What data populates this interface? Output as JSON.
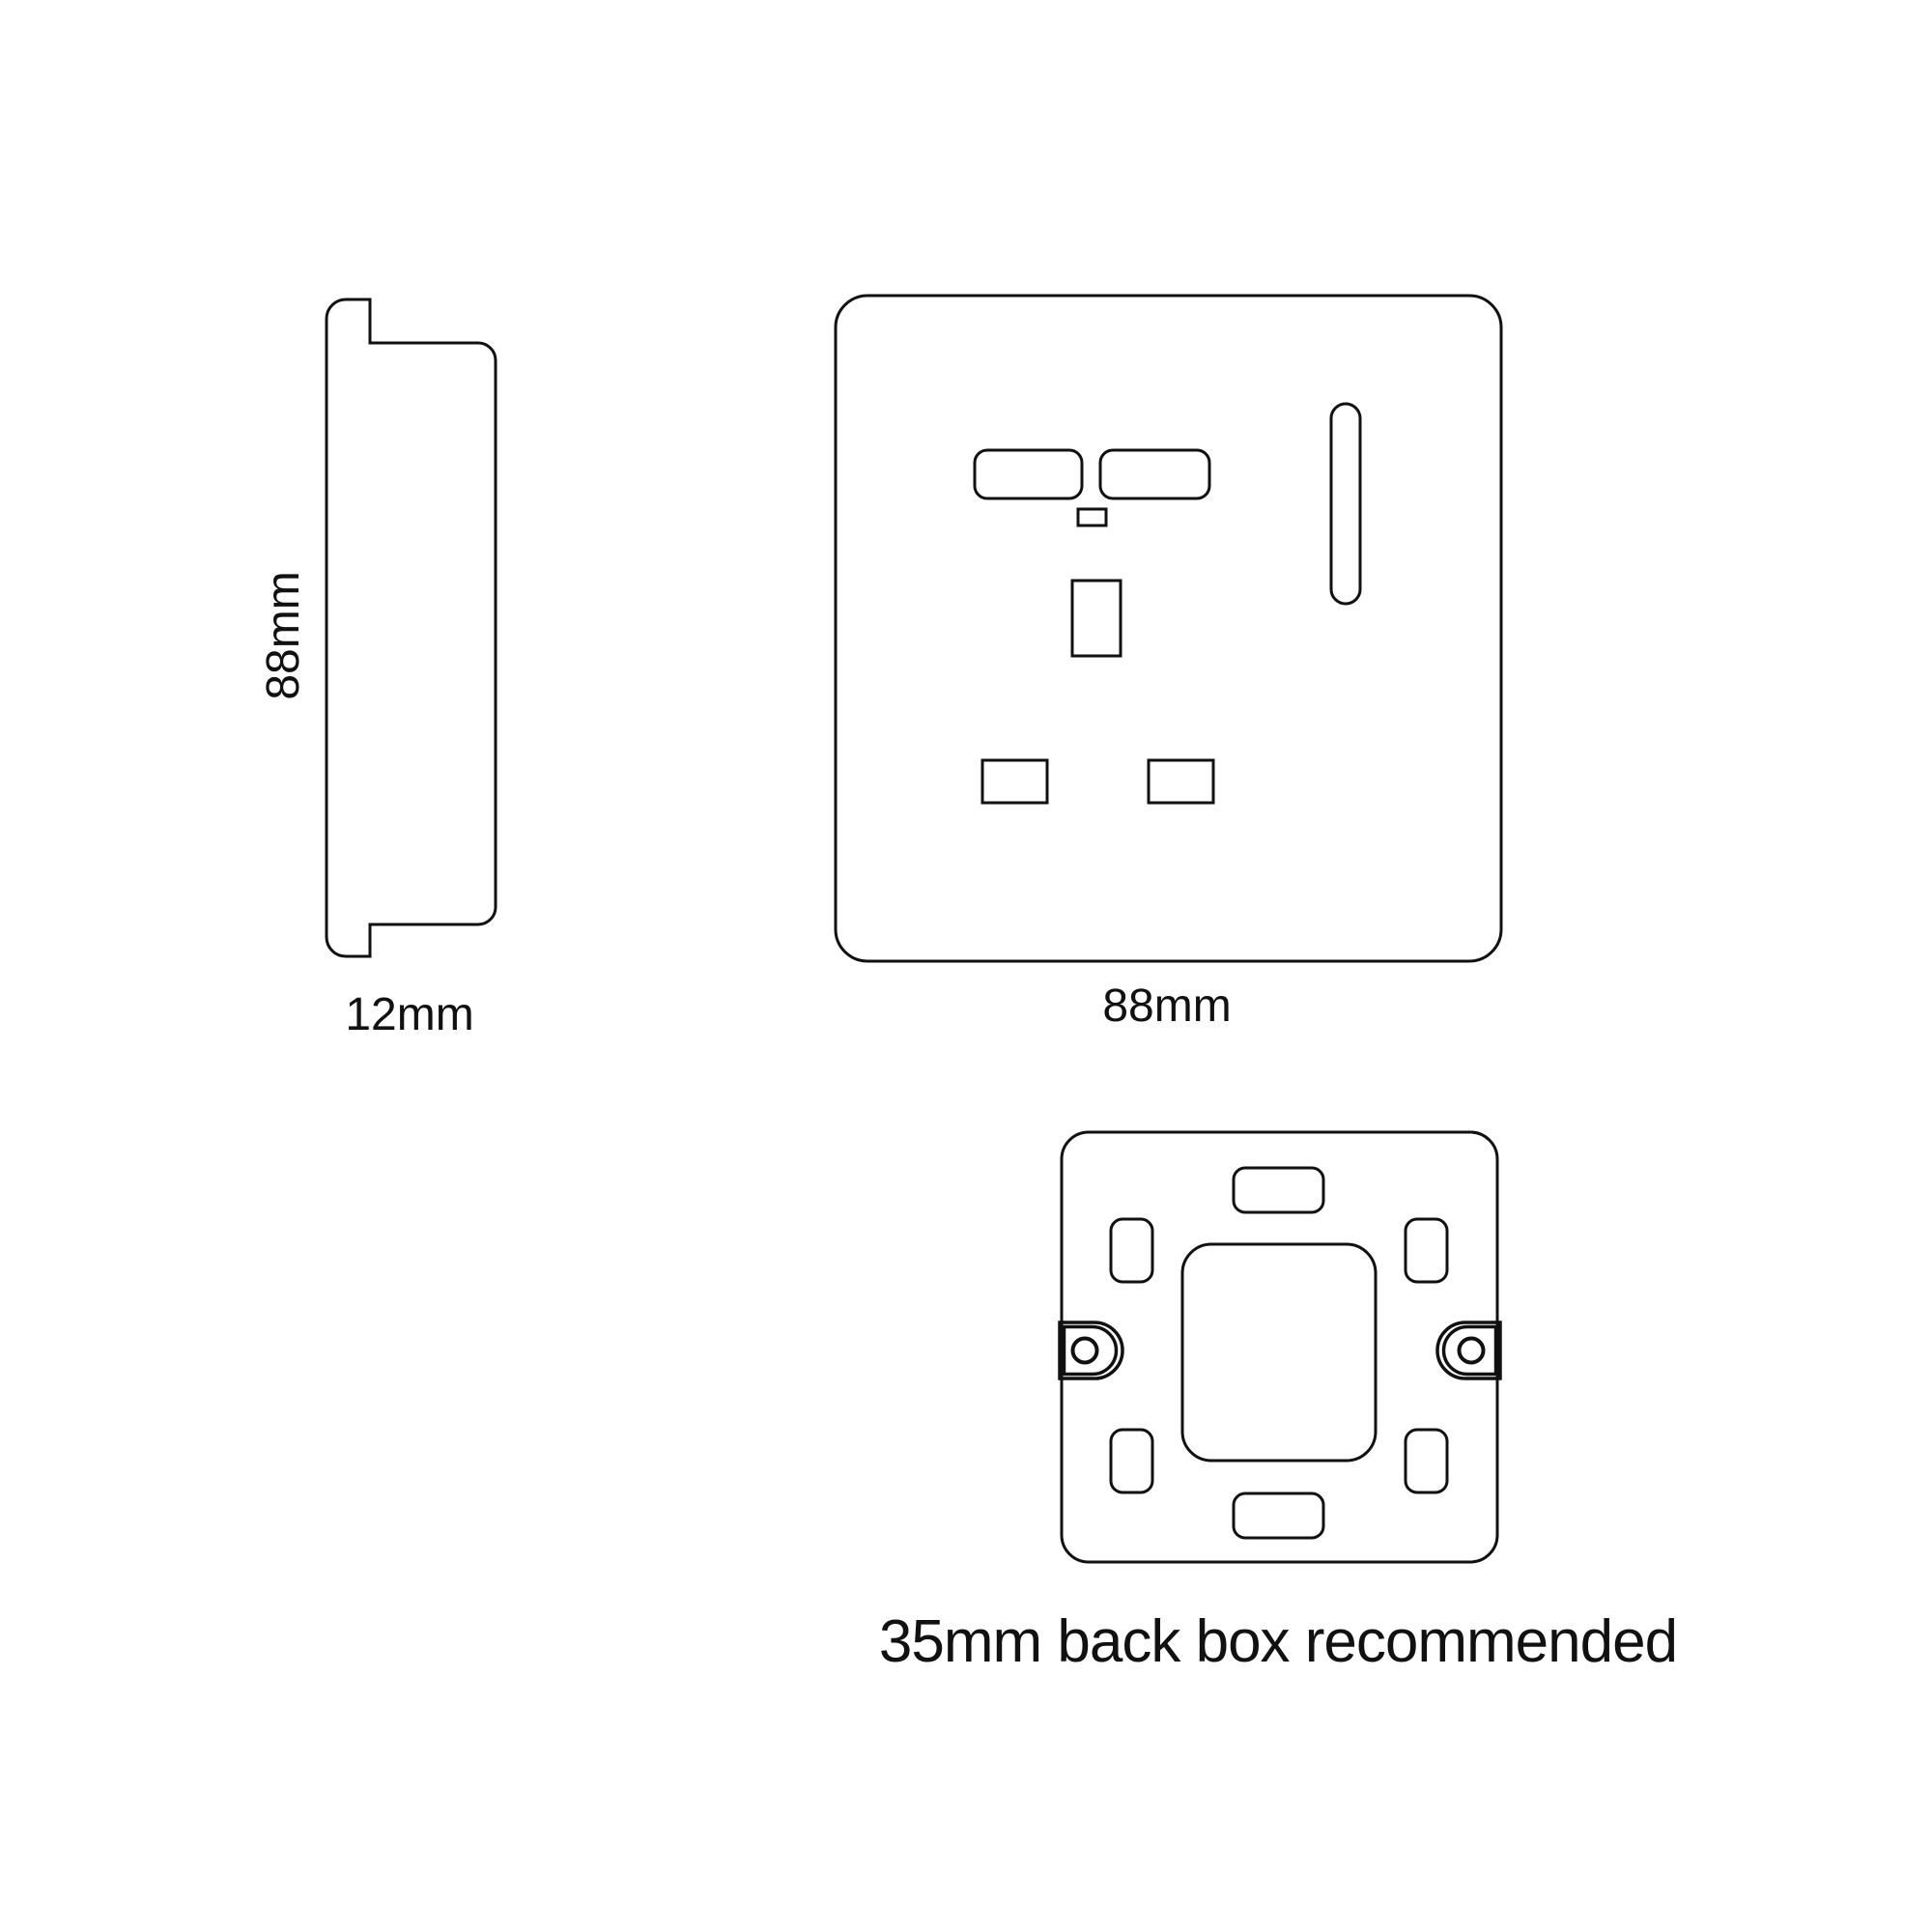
{
  "labels": {
    "side_height": "88mm",
    "side_depth": "12mm",
    "front_width": "88mm",
    "back_box_note": "35mm back box recommended"
  },
  "colors": {
    "line": "#111111",
    "text": "#111111",
    "background": "#ffffff"
  }
}
